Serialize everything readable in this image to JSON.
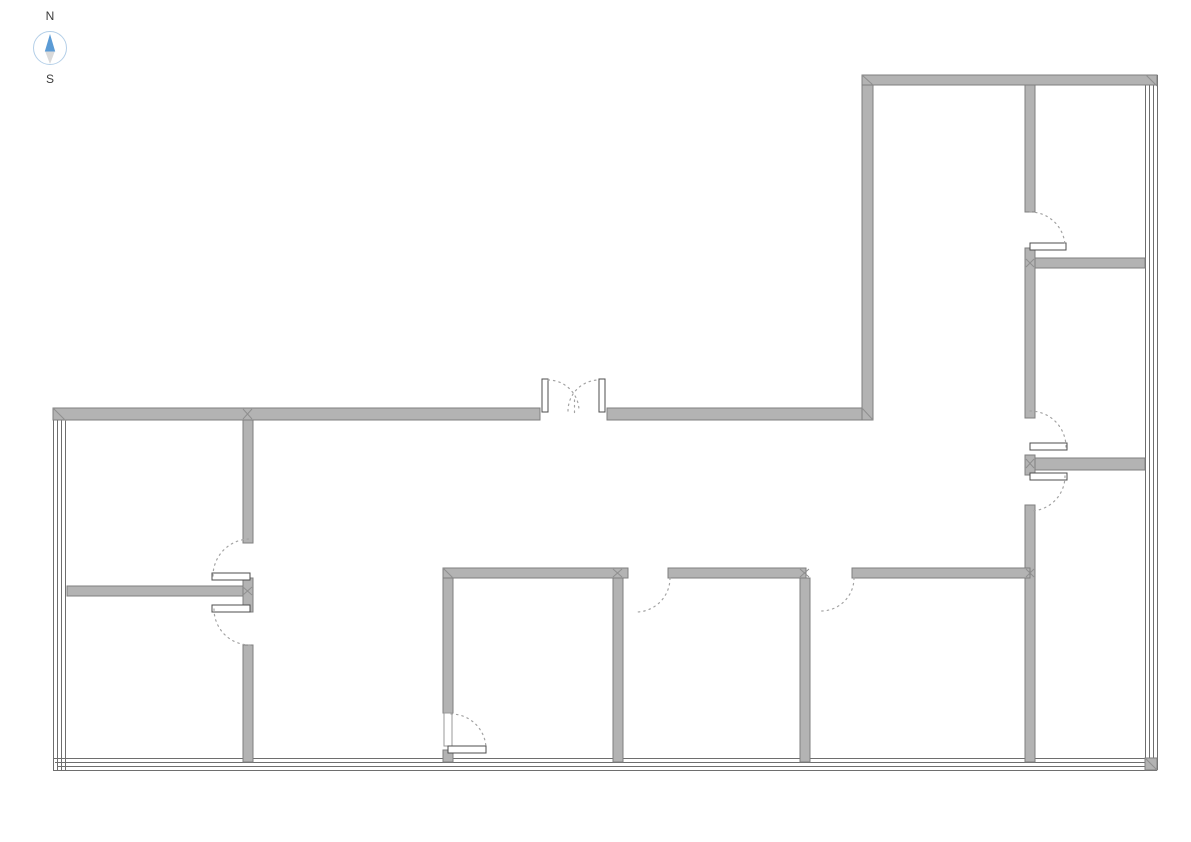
{
  "compass": {
    "north_label": "N",
    "south_label": "S",
    "needle_color": "#5b9bd5",
    "tail_color": "#dadada",
    "ring_color": "#b4cfe8",
    "label_color": "#3c3c3c"
  },
  "floorplan": {
    "canvas": {
      "width": 1191,
      "height": 842,
      "background": "#ffffff"
    },
    "style": {
      "wall_fill": "#b3b3b3",
      "wall_stroke": "#7f7f7f",
      "curtain_color": "#6e6e6e",
      "leaf_fill": "#ffffff",
      "leaf_stroke": "#4d4d4d",
      "frame_stroke": "#9a9a9a",
      "arc_color": "#a3a3a3",
      "miter_color": "#8f8f8f"
    },
    "walls": [
      {
        "name": "exterior-wall-north-left",
        "x": 53,
        "y": 408,
        "w": 487,
        "h": 12
      },
      {
        "name": "exterior-wall-north-right",
        "x": 607,
        "y": 408,
        "w": 266,
        "h": 12
      },
      {
        "name": "exterior-wall-wing-west",
        "x": 862,
        "y": 75,
        "w": 11,
        "h": 345
      },
      {
        "name": "exterior-wall-wing-north",
        "x": 862,
        "y": 75,
        "w": 295,
        "h": 10
      },
      {
        "name": "interior-wall-left-vertical-upper",
        "x": 243,
        "y": 420,
        "w": 10,
        "h": 123
      },
      {
        "name": "interior-wall-left-door-stub",
        "x": 243,
        "y": 578,
        "w": 10,
        "h": 34
      },
      {
        "name": "interior-wall-left-vertical-lower",
        "x": 243,
        "y": 645,
        "w": 10,
        "h": 117
      },
      {
        "name": "interior-wall-left-horizontal",
        "x": 67,
        "y": 586,
        "w": 176,
        "h": 10
      },
      {
        "name": "interior-wall-right-vertical-1",
        "x": 1025,
        "y": 85,
        "w": 10,
        "h": 127
      },
      {
        "name": "interior-wall-right-vertical-2",
        "x": 1025,
        "y": 248,
        "w": 10,
        "h": 170
      },
      {
        "name": "interior-wall-right-door-stub",
        "x": 1025,
        "y": 455,
        "w": 10,
        "h": 20
      },
      {
        "name": "interior-wall-right-vertical-3",
        "x": 1025,
        "y": 505,
        "w": 10,
        "h": 257
      },
      {
        "name": "interior-wall-right-horizontal-upper",
        "x": 1035,
        "y": 258,
        "w": 110,
        "h": 10
      },
      {
        "name": "interior-wall-right-horizontal-lower",
        "x": 1035,
        "y": 458,
        "w": 110,
        "h": 12
      },
      {
        "name": "interior-wall-bottom-horizontal-1",
        "x": 443,
        "y": 568,
        "w": 185,
        "h": 10
      },
      {
        "name": "interior-wall-bottom-horizontal-2",
        "x": 668,
        "y": 568,
        "w": 138,
        "h": 10
      },
      {
        "name": "interior-wall-bottom-horizontal-3",
        "x": 852,
        "y": 568,
        "w": 178,
        "h": 10
      },
      {
        "name": "interior-wall-room1-left-upper",
        "x": 443,
        "y": 578,
        "w": 10,
        "h": 135
      },
      {
        "name": "interior-wall-room1-left-lower",
        "x": 443,
        "y": 750,
        "w": 10,
        "h": 12
      },
      {
        "name": "interior-wall-room2-left",
        "x": 613,
        "y": 578,
        "w": 10,
        "h": 184
      },
      {
        "name": "interior-wall-room3-left",
        "x": 800,
        "y": 578,
        "w": 10,
        "h": 184
      },
      {
        "name": "corner-piece-bottom-right",
        "x": 1145,
        "y": 758,
        "w": 12,
        "h": 12
      }
    ],
    "curtain_lines": [
      {
        "name": "curtain-wall-west-line-1",
        "x1": 53.5,
        "y1": 408,
        "x2": 53.5,
        "y2": 770
      },
      {
        "name": "curtain-wall-west-line-2",
        "x1": 57.5,
        "y1": 410,
        "x2": 57.5,
        "y2": 770
      },
      {
        "name": "curtain-wall-west-line-3",
        "x1": 61.5,
        "y1": 412,
        "x2": 61.5,
        "y2": 770
      },
      {
        "name": "curtain-wall-west-line-4",
        "x1": 65.5,
        "y1": 414,
        "x2": 65.5,
        "y2": 770
      },
      {
        "name": "curtain-wall-south-line-1",
        "x1": 53,
        "y1": 758.5,
        "x2": 1157,
        "y2": 758.5
      },
      {
        "name": "curtain-wall-south-line-2",
        "x1": 55,
        "y1": 762.5,
        "x2": 1157,
        "y2": 762.5
      },
      {
        "name": "curtain-wall-south-line-3",
        "x1": 57,
        "y1": 766.5,
        "x2": 1157,
        "y2": 766.5
      },
      {
        "name": "curtain-wall-south-line-4",
        "x1": 53,
        "y1": 770.5,
        "x2": 1157,
        "y2": 770.5
      },
      {
        "name": "curtain-wall-east-line-1",
        "x1": 1145.5,
        "y1": 80,
        "x2": 1145.5,
        "y2": 770
      },
      {
        "name": "curtain-wall-east-line-2",
        "x1": 1149.5,
        "y1": 80,
        "x2": 1149.5,
        "y2": 770
      },
      {
        "name": "curtain-wall-east-line-3",
        "x1": 1153.5,
        "y1": 78,
        "x2": 1153.5,
        "y2": 770
      },
      {
        "name": "curtain-wall-east-line-4",
        "x1": 1157.5,
        "y1": 75,
        "x2": 1157.5,
        "y2": 770
      }
    ],
    "door_leaves": [
      {
        "name": "entry-double-door-left-leaf",
        "x": 542,
        "y": 379,
        "w": 6,
        "h": 33
      },
      {
        "name": "entry-double-door-right-leaf",
        "x": 599,
        "y": 379,
        "w": 6,
        "h": 33
      },
      {
        "name": "door-leaf-top-right-room",
        "x": 1030,
        "y": 243,
        "w": 36,
        "h": 7
      },
      {
        "name": "door-leaf-middle-right-room",
        "x": 1030,
        "y": 443,
        "w": 37,
        "h": 7
      },
      {
        "name": "door-leaf-bottom-right-room",
        "x": 1030,
        "y": 473,
        "w": 37,
        "h": 7
      },
      {
        "name": "door-leaf-left-upper-room",
        "x": 212,
        "y": 573,
        "w": 38,
        "h": 7
      },
      {
        "name": "door-leaf-left-lower-room",
        "x": 212,
        "y": 605,
        "w": 38,
        "h": 7
      },
      {
        "name": "door-leaf-room1",
        "x": 448,
        "y": 746,
        "w": 38,
        "h": 7
      }
    ],
    "door_frames": [
      {
        "name": "door-frame-room1",
        "x": 444,
        "y": 713,
        "w": 8,
        "h": 33
      }
    ],
    "door_arcs": [
      {
        "name": "entry-double-door-left-swing",
        "cx": 548,
        "cy": 411,
        "r": 31,
        "a0": 270,
        "a1": 360
      },
      {
        "name": "entry-double-door-right-swing",
        "cx": 599,
        "cy": 411,
        "r": 31,
        "a0": 180,
        "a1": 270
      },
      {
        "name": "door-swing-top-right-room",
        "cx": 1030,
        "cy": 247,
        "r": 35,
        "a0": 270,
        "a1": 360
      },
      {
        "name": "door-swing-middle-right-room",
        "cx": 1030,
        "cy": 447,
        "r": 36,
        "a0": 270,
        "a1": 360
      },
      {
        "name": "door-swing-bottom-right-room",
        "cx": 1030,
        "cy": 476,
        "r": 35,
        "a0": 0,
        "a1": 90
      },
      {
        "name": "door-swing-left-upper-room",
        "cx": 250,
        "cy": 576,
        "r": 37,
        "a0": 180,
        "a1": 270
      },
      {
        "name": "door-swing-left-lower-room",
        "cx": 250,
        "cy": 609,
        "r": 36,
        "a0": 90,
        "a1": 180
      },
      {
        "name": "door-swing-room1",
        "cx": 451,
        "cy": 749,
        "r": 35,
        "a0": 270,
        "a1": 360
      },
      {
        "name": "door-swing-room2",
        "cx": 636,
        "cy": 578,
        "r": 34,
        "a0": 0,
        "a1": 90
      },
      {
        "name": "door-swing-room3",
        "cx": 821,
        "cy": 578,
        "r": 33,
        "a0": 0,
        "a1": 90
      }
    ],
    "dashes": [
      {
        "name": "double-door-center-line",
        "x1": 574.5,
        "y1": 400,
        "x2": 574.5,
        "y2": 413
      }
    ],
    "miters": [
      {
        "name": "miter-nw-corner",
        "x1": 53,
        "y1": 408,
        "x2": 66,
        "y2": 421
      },
      {
        "name": "miter-t-left-a",
        "x1": 243,
        "y1": 409,
        "x2": 252,
        "y2": 419
      },
      {
        "name": "miter-t-left-b",
        "x1": 252,
        "y1": 409,
        "x2": 243,
        "y2": 419
      },
      {
        "name": "miter-wing-inner-corner",
        "x1": 862,
        "y1": 408,
        "x2": 873,
        "y2": 420
      },
      {
        "name": "miter-wing-nw-corner",
        "x1": 862,
        "y1": 75,
        "x2": 873,
        "y2": 85
      },
      {
        "name": "miter-wing-ne-corner",
        "x1": 1146,
        "y1": 75,
        "x2": 1157,
        "y2": 86
      },
      {
        "name": "miter-room1-corner",
        "x1": 443,
        "y1": 568,
        "x2": 453,
        "y2": 578
      },
      {
        "name": "miter-t-room2-a",
        "x1": 613,
        "y1": 569,
        "x2": 622,
        "y2": 577
      },
      {
        "name": "miter-t-room2-b",
        "x1": 622,
        "y1": 569,
        "x2": 613,
        "y2": 577
      },
      {
        "name": "miter-t-room3-a",
        "x1": 800,
        "y1": 569,
        "x2": 809,
        "y2": 577
      },
      {
        "name": "miter-t-room3-b",
        "x1": 809,
        "y1": 569,
        "x2": 800,
        "y2": 577
      },
      {
        "name": "miter-t-right-bottom-a",
        "x1": 1026,
        "y1": 569,
        "x2": 1034,
        "y2": 577
      },
      {
        "name": "miter-t-right-bottom-b",
        "x1": 1034,
        "y1": 569,
        "x2": 1026,
        "y2": 577
      },
      {
        "name": "miter-t-right-mid-a",
        "x1": 1026,
        "y1": 459,
        "x2": 1034,
        "y2": 468
      },
      {
        "name": "miter-t-right-mid-b",
        "x1": 1034,
        "y1": 459,
        "x2": 1026,
        "y2": 468
      },
      {
        "name": "miter-t-right-up-a",
        "x1": 1026,
        "y1": 259,
        "x2": 1034,
        "y2": 267
      },
      {
        "name": "miter-t-right-up-b",
        "x1": 1034,
        "y1": 259,
        "x2": 1026,
        "y2": 267
      },
      {
        "name": "miter-t-left-mid-a",
        "x1": 243,
        "y1": 587,
        "x2": 252,
        "y2": 595
      },
      {
        "name": "miter-t-left-mid-b",
        "x1": 252,
        "y1": 587,
        "x2": 243,
        "y2": 595
      },
      {
        "name": "miter-se-corner",
        "x1": 1145,
        "y1": 758,
        "x2": 1157,
        "y2": 770
      }
    ]
  }
}
